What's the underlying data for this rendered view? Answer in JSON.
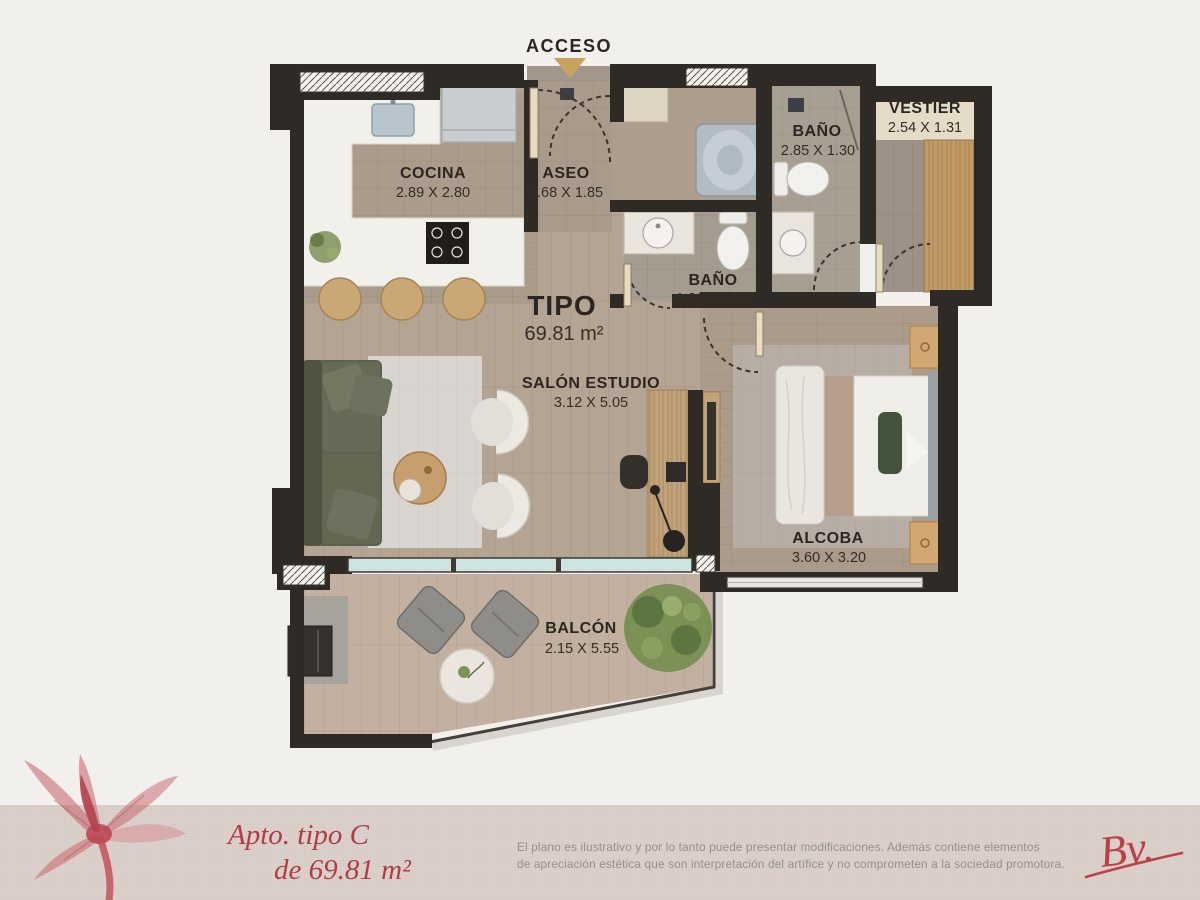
{
  "plan": {
    "access_label": "ACCESO",
    "type_label": "TIPO",
    "type_area": "69.81 m²",
    "rooms": {
      "cocina": {
        "name": "COCINA",
        "dims": "2.89 X 2.80"
      },
      "aseo": {
        "name": "ASEO",
        "dims": "1.68 X 1.85"
      },
      "bano_principal": {
        "name": "BAÑO",
        "dims": "2.85 X 1.30"
      },
      "vestier": {
        "name": "VESTIER",
        "dims": "2.54 X 1.31"
      },
      "bano": {
        "name": "BAÑO",
        "dims": "1.26 X 1.85"
      },
      "salon_estudio": {
        "name": "SALÓN ESTUDIO",
        "dims": "3.12 X 5.05"
      },
      "alcoba": {
        "name": "ALCOBA",
        "dims": "3.60 X 3.20"
      },
      "balcon": {
        "name": "BALCÓN",
        "dims": "2.15 X 5.55"
      }
    }
  },
  "footer": {
    "unit_line1": "Apto. tipo C",
    "unit_line2": "de 69.81 m²",
    "disclaimer_line1": "El plano es ilustrativo y por lo tanto puede presentar modificaciones. Además contiene elementos",
    "disclaimer_line2": "de apreciación estética que son interpretación del artífice y no comprometen a la sociedad promotora.",
    "logo_text": "Bv."
  },
  "colors": {
    "accent_red": "#b23c46",
    "wall_dark": "#2e2a26",
    "access_arrow_gold": "#c8a35e",
    "footer_band": "#dbd0ca",
    "glass_teal": "#cfe3e0",
    "sofa_green": "#5d6250",
    "wood_tan": "#c2a279"
  }
}
